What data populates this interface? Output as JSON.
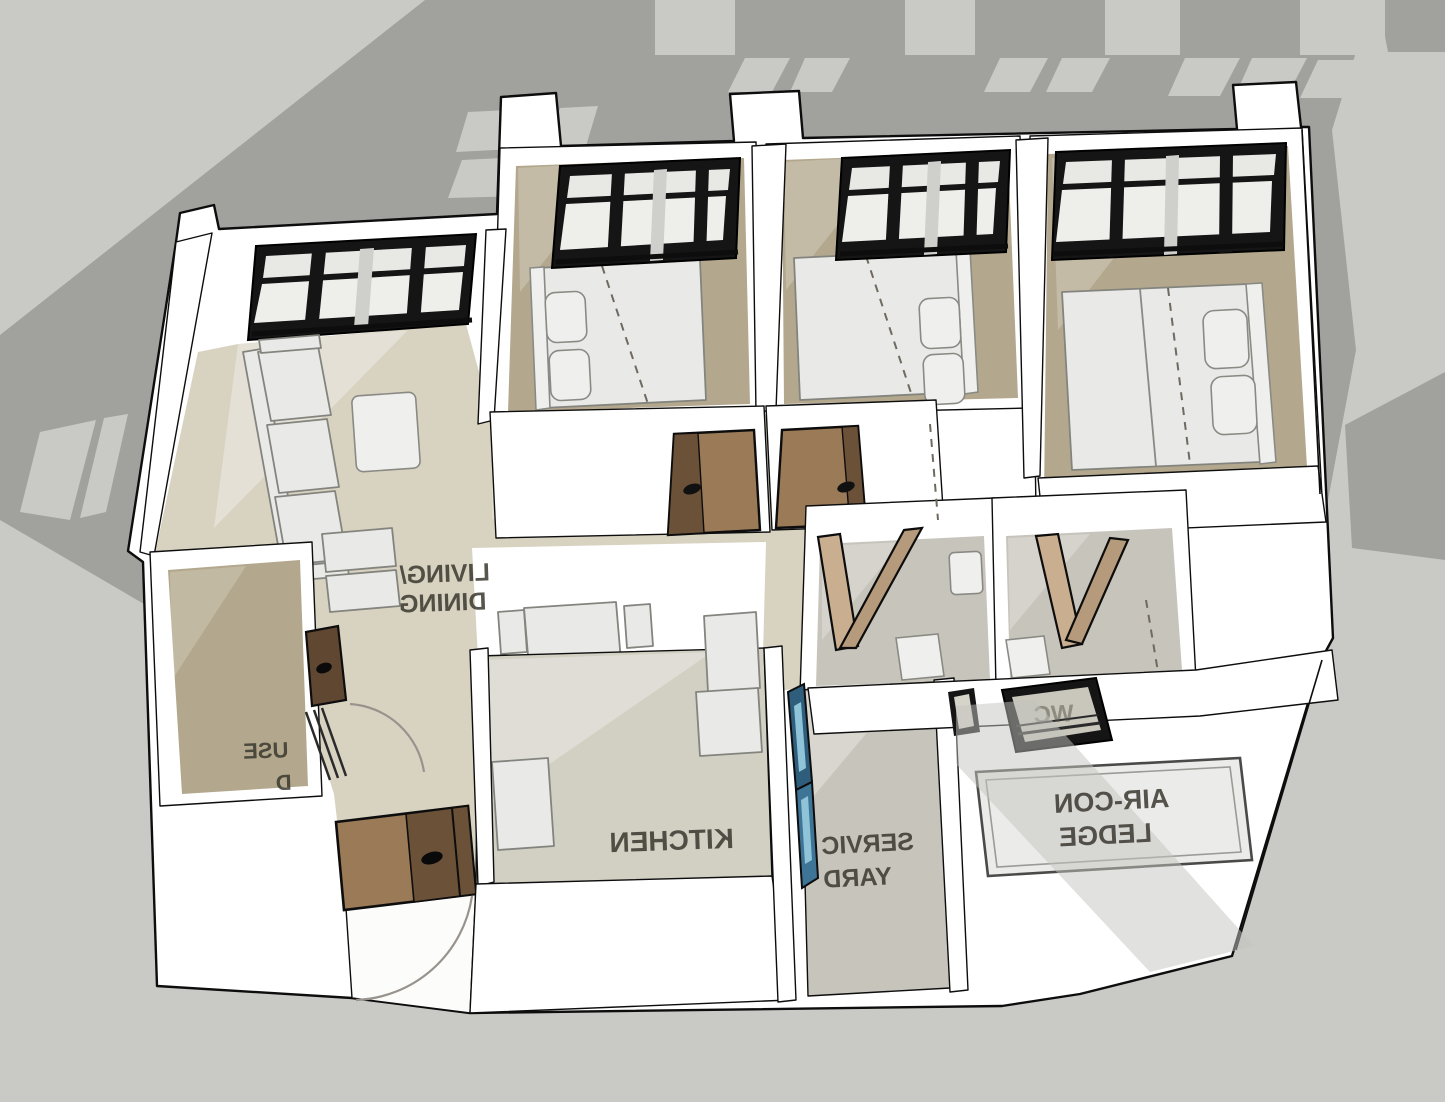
{
  "scene": {
    "description": "SketchUp-style 3D axonometric dollhouse render of a 3-bedroom apartment floor plan; room labels appear mirrored because the plan text is viewed flipped",
    "background": "building cast shadow with window-slit highlights"
  },
  "rooms": {
    "living_dining": {
      "label_line1": "LIVING/",
      "label_line2": "DINING"
    },
    "kitchen": {
      "label": "KITCHEN"
    },
    "main_bedroom": {
      "label": "MAIN"
    },
    "service_yard": {
      "label_line1": "SERVIC",
      "label_line2": "YARD"
    },
    "aircon_ledge": {
      "label_line1": "AIR-CON",
      "label_line2": "LEDGE"
    },
    "household_shelter": {
      "label_fragment_line1": "USE",
      "label_fragment_line2": "D"
    },
    "wc": {
      "label_fragment": "WC"
    }
  },
  "colors": {
    "background": "#c9c9c5",
    "cast_shadow": "#a1a19d",
    "wall_white": "#ffffff",
    "outline": "#0d0d0d",
    "floor_living": "#d8d2c1",
    "floor_bedroom": "#b3a88d",
    "floor_kitchen": "#d2cfc3",
    "floor_wet_area": "#c7c4bb",
    "door_wood_light": "#9b7a58",
    "door_wood_dark": "#6b5138",
    "bifold_wood": "#c9ae90",
    "glass_blue": "#2f5d7c",
    "window_frame": "#151515",
    "furniture": "#e9e9e7",
    "label_text": "#3a382f",
    "aircon_panel": "#ebebe9"
  }
}
